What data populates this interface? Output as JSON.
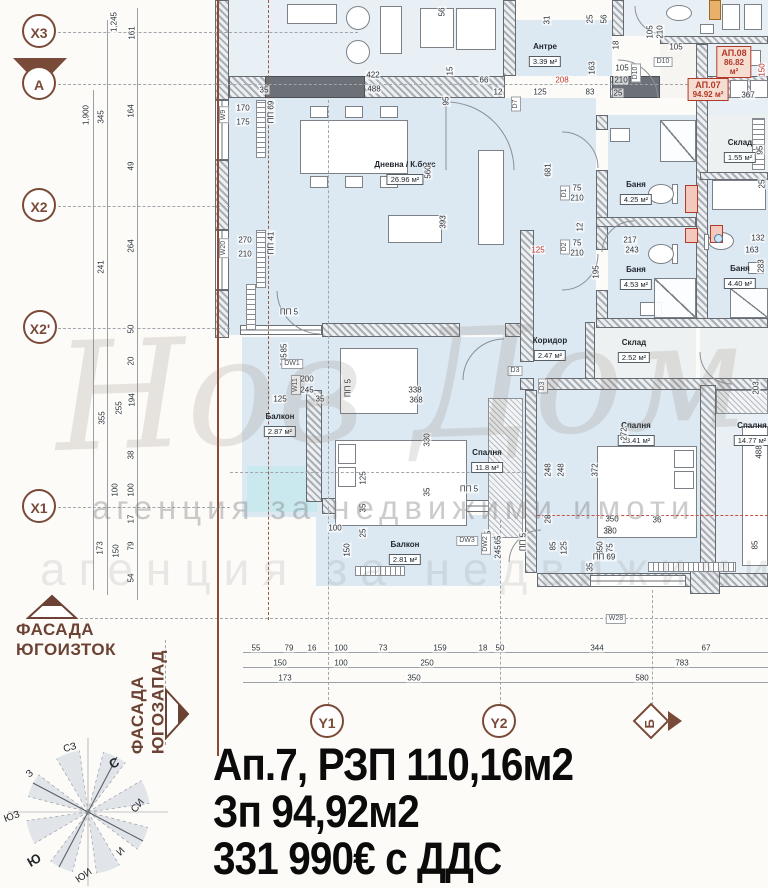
{
  "title_block": {
    "line1": "Ап.7, РЗП 110,16м2",
    "line2": "Зп 94,92м2",
    "line3": "331 990€ с ДДС"
  },
  "facades": {
    "southeast_line1": "ФАСАДА",
    "southeast_line2": "ЮГОИЗТОК",
    "southwest_line1": "ФАСАДА",
    "southwest_line2": "ЮГОЗАПАД"
  },
  "watermark": {
    "script": "Нов Дом",
    "tagline": "агенция за недвижими имоти"
  },
  "colors": {
    "accent_brown": "#7a4a38",
    "accent_red": "#b03a2a",
    "floor_blue": "#dce8f2",
    "balcony_cyan": "#c9e9ef",
    "wall_gray": "#6b7177"
  },
  "axes": {
    "left": [
      {
        "label": "X3",
        "x": 22,
        "y": 14
      },
      {
        "label": "A",
        "x": 22,
        "y": 66,
        "marker": true
      },
      {
        "label": "X2",
        "x": 22,
        "y": 188
      },
      {
        "label": "X2'",
        "x": 23,
        "y": 310
      },
      {
        "label": "X1",
        "x": 22,
        "y": 489
      }
    ],
    "bottom": [
      {
        "label": "Y1",
        "x": 310,
        "y": 704,
        "shape": "circle"
      },
      {
        "label": "Y2",
        "x": 482,
        "y": 704,
        "shape": "circle"
      },
      {
        "label": "Б",
        "x": 638,
        "y": 708,
        "shape": "diamond"
      }
    ]
  },
  "compass_points": [
    {
      "t": "С",
      "x": 114,
      "y": 763,
      "b": 1,
      "rot": -28
    },
    {
      "t": "СЗ",
      "x": 70,
      "y": 748,
      "rot": -15
    },
    {
      "t": "З",
      "x": 30,
      "y": 774,
      "rot": -40
    },
    {
      "t": "ЮЗ",
      "x": 12,
      "y": 817,
      "rot": -20
    },
    {
      "t": "Ю",
      "x": 34,
      "y": 860,
      "b": 1,
      "rot": -30
    },
    {
      "t": "ЮИ",
      "x": 84,
      "y": 876,
      "rot": -35
    },
    {
      "t": "И",
      "x": 121,
      "y": 852,
      "rot": -45
    },
    {
      "t": "СИ",
      "x": 138,
      "y": 806,
      "rot": -50
    }
  ],
  "rooms": [
    {
      "name": "Дневна / К.бокс",
      "area": "26.96 м²",
      "x": 405,
      "y": 160
    },
    {
      "name": "Антре",
      "area": "3.39 м²",
      "x": 545,
      "y": 42
    },
    {
      "name": "Баня",
      "area": "4.25 м²",
      "x": 636,
      "y": 180
    },
    {
      "name": "Баня",
      "area": "4.53 м²",
      "x": 636,
      "y": 265
    },
    {
      "name": "Баня",
      "area": "4.40 м²",
      "x": 740,
      "y": 264
    },
    {
      "name": "Склад",
      "area": "1.55 м²",
      "x": 740,
      "y": 138
    },
    {
      "name": "Склад",
      "area": "2.52 м²",
      "x": 634,
      "y": 338
    },
    {
      "name": "Коридор",
      "area": "2.47 м²",
      "x": 550,
      "y": 336
    },
    {
      "name": "Спалня",
      "area": "11.8 м²",
      "x": 487,
      "y": 448
    },
    {
      "name": "Спалня",
      "area": "13.41 м²",
      "x": 636,
      "y": 421
    },
    {
      "name": "Спалня",
      "area": "14.77 м²",
      "x": 752,
      "y": 421
    },
    {
      "name": "Балкон",
      "area": "2.87 м²",
      "x": 280,
      "y": 412
    },
    {
      "name": "Балкон",
      "area": "2.81 м²",
      "x": 405,
      "y": 540
    }
  ],
  "apartments": [
    {
      "label": "АП.08",
      "area": "86.82 м²",
      "x": 734,
      "y": 46
    },
    {
      "label": "АП.07",
      "area": "94.92 м²",
      "x": 708,
      "y": 78
    }
  ],
  "tags": [
    [
      "W9",
      224,
      115,
      1
    ],
    [
      "W20",
      224,
      248,
      1
    ],
    [
      "DW1",
      292,
      364,
      0
    ],
    [
      "W11",
      296,
      385,
      1
    ],
    [
      "D7",
      516,
      104,
      1
    ],
    [
      "D1",
      565,
      193,
      1
    ],
    [
      "D2",
      565,
      247,
      1
    ],
    [
      "D3",
      515,
      371,
      0
    ],
    [
      "D3",
      543,
      386,
      1
    ],
    [
      "D10",
      663,
      62,
      0
    ],
    [
      "D10",
      636,
      73,
      1
    ],
    [
      "DW3",
      467,
      541,
      0
    ],
    [
      "DW2",
      486,
      544,
      1
    ],
    [
      "W28",
      616,
      619,
      0
    ]
  ],
  "dims": [
    [
      "1,245",
      114,
      22,
      1
    ],
    [
      "161",
      132,
      33,
      1
    ],
    [
      "1,900",
      86,
      115,
      1
    ],
    [
      "345",
      101,
      117,
      1
    ],
    [
      "164",
      131,
      111,
      1
    ],
    [
      "49",
      131,
      166,
      1
    ],
    [
      "264",
      131,
      246,
      1
    ],
    [
      "241",
      101,
      267,
      1
    ],
    [
      "50",
      131,
      329,
      1
    ],
    [
      "20",
      131,
      361,
      1
    ],
    [
      "355",
      102,
      418,
      1
    ],
    [
      "255",
      119,
      408,
      1
    ],
    [
      "194",
      132,
      400,
      1
    ],
    [
      "38",
      131,
      455,
      1
    ],
    [
      "100",
      115,
      490,
      1
    ],
    [
      "100",
      131,
      490,
      1
    ],
    [
      "17",
      131,
      519,
      1
    ],
    [
      "173",
      100,
      548,
      1
    ],
    [
      "150",
      116,
      551,
      1
    ],
    [
      "79",
      131,
      546,
      1
    ],
    [
      "54",
      131,
      578,
      1
    ],
    [
      "35",
      264,
      90,
      0
    ],
    [
      "422",
      373,
      75,
      0
    ],
    [
      "488",
      374,
      89,
      0
    ],
    [
      "56",
      442,
      12,
      1
    ],
    [
      "15",
      450,
      71,
      1
    ],
    [
      "95",
      446,
      101,
      1
    ],
    [
      "560",
      428,
      172,
      1
    ],
    [
      "25",
      590,
      19,
      1
    ],
    [
      "56",
      604,
      19,
      1
    ],
    [
      "31",
      547,
      20,
      1
    ],
    [
      "66",
      484,
      80,
      0
    ],
    [
      "12",
      498,
      92,
      0
    ],
    [
      "125",
      540,
      92,
      0
    ],
    [
      "83",
      590,
      92,
      0
    ],
    [
      "25",
      618,
      93,
      0
    ],
    [
      "208",
      562,
      80,
      0,
      1
    ],
    [
      "163",
      592,
      68,
      1
    ],
    [
      "18",
      616,
      45,
      1
    ],
    [
      "105",
      622,
      68,
      0
    ],
    [
      "210",
      621,
      80,
      0
    ],
    [
      "105",
      650,
      32,
      1
    ],
    [
      "210",
      660,
      32,
      1
    ],
    [
      "105",
      676,
      47,
      0
    ],
    [
      "367",
      748,
      95,
      0
    ],
    [
      "150",
      762,
      70,
      1,
      1
    ],
    [
      "95",
      760,
      150,
      1
    ],
    [
      "25",
      762,
      184,
      1
    ],
    [
      "170",
      243,
      108,
      0
    ],
    [
      "175",
      243,
      122,
      0
    ],
    [
      "270",
      245,
      240,
      0
    ],
    [
      "210",
      245,
      254,
      0
    ],
    [
      "681",
      548,
      170,
      1
    ],
    [
      "393",
      443,
      222,
      1
    ],
    [
      "125",
      538,
      250,
      0,
      1
    ],
    [
      "217",
      630,
      240,
      0
    ],
    [
      "243",
      632,
      250,
      0
    ],
    [
      "195",
      596,
      272,
      1
    ],
    [
      "12",
      580,
      227,
      1
    ],
    [
      "75",
      577,
      188,
      0
    ],
    [
      "210",
      577,
      198,
      0
    ],
    [
      "75",
      577,
      243,
      0
    ],
    [
      "210",
      577,
      253,
      0
    ],
    [
      "132",
      758,
      238,
      0
    ],
    [
      "163",
      752,
      250,
      0
    ],
    [
      "283",
      761,
      266,
      1
    ],
    [
      "85",
      284,
      348,
      1
    ],
    [
      "245",
      284,
      360,
      1
    ],
    [
      "200",
      307,
      379,
      0
    ],
    [
      "245",
      307,
      390,
      0
    ],
    [
      "125",
      280,
      399,
      0
    ],
    [
      "35",
      320,
      399,
      0
    ],
    [
      "338",
      415,
      390,
      0
    ],
    [
      "368",
      416,
      400,
      0
    ],
    [
      "330",
      427,
      440,
      1
    ],
    [
      "35",
      427,
      492,
      1
    ],
    [
      "272",
      624,
      434,
      1
    ],
    [
      "248",
      548,
      470,
      1
    ],
    [
      "248",
      561,
      470,
      1
    ],
    [
      "372",
      595,
      470,
      1
    ],
    [
      "203",
      756,
      388,
      1
    ],
    [
      "488",
      759,
      452,
      1
    ],
    [
      "125",
      363,
      478,
      1
    ],
    [
      "35",
      363,
      508,
      1
    ],
    [
      "25",
      363,
      533,
      1
    ],
    [
      "100",
      335,
      528,
      0
    ],
    [
      "150",
      347,
      550,
      1
    ],
    [
      "65",
      498,
      540,
      1
    ],
    [
      "245",
      498,
      552,
      1
    ],
    [
      "85",
      553,
      546,
      1
    ],
    [
      "125",
      564,
      548,
      1
    ],
    [
      "50",
      609,
      530,
      1
    ],
    [
      "28",
      548,
      519,
      1
    ],
    [
      "350",
      612,
      519,
      0
    ],
    [
      "380",
      610,
      531,
      0
    ],
    [
      "36",
      657,
      520,
      0
    ],
    [
      "35",
      590,
      567,
      1
    ],
    [
      "350",
      600,
      548,
      1
    ],
    [
      "175",
      610,
      550,
      1
    ],
    [
      "85",
      755,
      545,
      1
    ],
    [
      "ПП 5",
      289,
      312,
      0
    ],
    [
      "ПП 5",
      348,
      388,
      1
    ],
    [
      "ПП 5",
      469,
      489,
      0
    ],
    [
      "ПП 5",
      523,
      542,
      1
    ],
    [
      "ПП 15",
      488,
      542,
      1
    ],
    [
      "ПП 69",
      604,
      557,
      0
    ],
    [
      "ПП 69",
      271,
      112,
      1
    ],
    [
      "ПП 41",
      271,
      243,
      1
    ],
    [
      "55",
      256,
      648,
      0
    ],
    [
      "79",
      289,
      648,
      0
    ],
    [
      "16",
      312,
      648,
      0
    ],
    [
      "100",
      341,
      648,
      0
    ],
    [
      "73",
      383,
      648,
      0
    ],
    [
      "159",
      440,
      648,
      0
    ],
    [
      "18",
      483,
      648,
      0
    ],
    [
      "50",
      500,
      648,
      0
    ],
    [
      "344",
      597,
      648,
      0
    ],
    [
      "67",
      706,
      648,
      0
    ],
    [
      "150",
      280,
      663,
      0
    ],
    [
      "100",
      341,
      663,
      0
    ],
    [
      "250",
      427,
      663,
      0
    ],
    [
      "783",
      682,
      663,
      0
    ],
    [
      "173",
      285,
      678,
      0
    ],
    [
      "350",
      414,
      678,
      0
    ],
    [
      "580",
      642,
      678,
      0
    ]
  ]
}
